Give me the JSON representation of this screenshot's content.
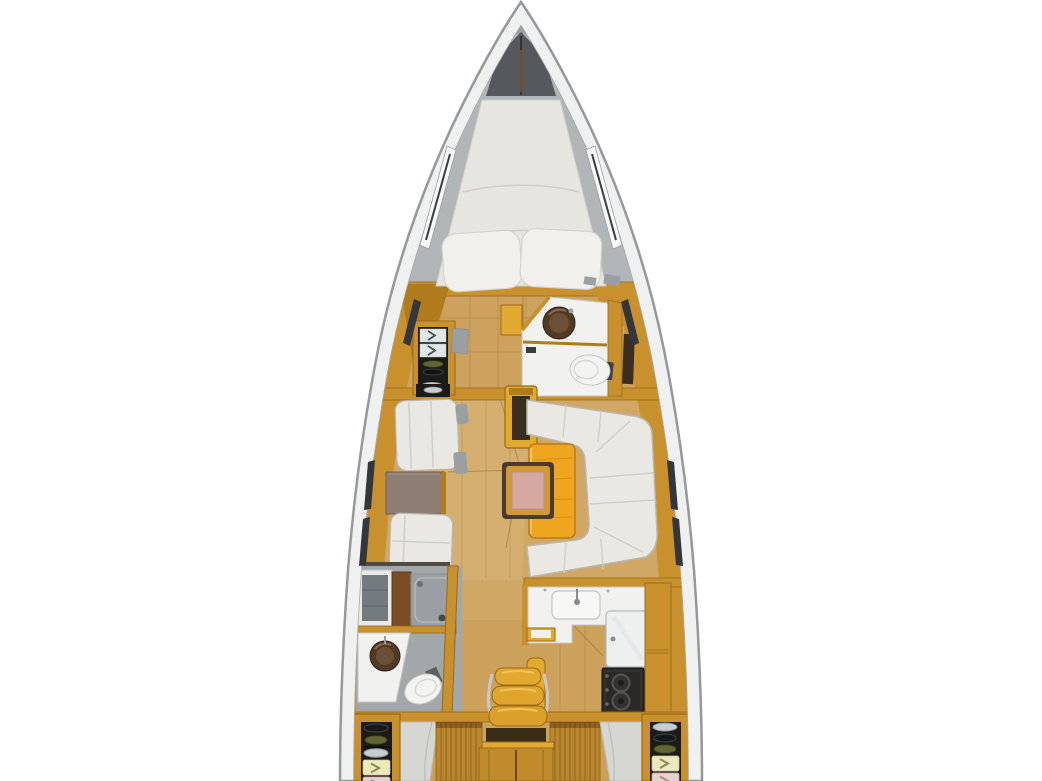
{
  "meta": {
    "description": "Top-down interior floor plan rendering of a sailing yacht hull",
    "canvas": {
      "width_px": 1042,
      "height_px": 781
    },
    "text_content": "none (image contains no rendered text)"
  },
  "areas": [
    "bow-anchor-locker",
    "forward-cabin-v-berth",
    "forward-wardrobe",
    "forward-head-toilet",
    "salon-port-settees",
    "salon-port-table",
    "mast-post",
    "salon-u-settee",
    "salon-table",
    "folding-table-leaf",
    "aft-head-shower",
    "galley",
    "nav-seat",
    "companionway-steps",
    "aft-cabin-port",
    "aft-cabin-starboard",
    "storage-locker-port",
    "storage-locker-starboard"
  ],
  "palette": {
    "pageBg": "#ffffff",
    "hullStroke": "#96989b",
    "hullFill": "#eff0f0",
    "hullLip": "#a6a9ab",
    "deck": "#b2b5b7",
    "bowTip": "#9b9ea1",
    "anchorLocker": "#55585c",
    "chainBrown": "#8a5a20",
    "floorWood": "#d0a765",
    "floorWoodAft": "#c59b53",
    "floorWoodLight": "#dcbc82",
    "plankLine": "#7a4a14",
    "woodTrim": "#c8912e",
    "woodTrimDark": "#9a6a14",
    "woodTrimDeep": "#b07b1d",
    "woodTrimLight": "#e2a930",
    "tableYellow": "#efa51f",
    "tableYellowEdge": "#b97d12",
    "slatWood": "#b8862f",
    "leafPink": "#d5a9a2",
    "leafFrame": "#4a3a30",
    "cushionWhite": "#e9e8e3",
    "cushionEdge": "#b9b8b2",
    "pillowWhite": "#f1f0ec",
    "mattressWhite": "#e6e5e0",
    "seamGray": "#cfcec8",
    "portTableBrown": "#8d7d73",
    "counterWhite": "#f1f1ef",
    "counterEdge": "#c6c7c3",
    "bathFloorGray": "#a2a7aa",
    "bathWallGray": "#747b7f",
    "showerTray": "#999fa2",
    "cabinetBrown": "#7a4e22",
    "sinkBowlDark": "#523a27",
    "sinkBowlMid": "#6b4f36",
    "stoveBlack": "#2b2927",
    "stoveRing": "#575350",
    "fridgeWhite": "#eef0f0",
    "shelfBlack": "#1d1b19",
    "dishOlive": "#5f6632",
    "dishSilver": "#c9cdd0",
    "panelCream": "#eceabc",
    "panelPink": "#e6d2ce",
    "chevCream": "#8c8a56",
    "chevPink": "#b08a84",
    "mirrorPanel": "#dfe8e6",
    "chevMirror": "#44534f",
    "hullSlot": "#33363a",
    "chromeWhite": "#f7f8f8",
    "metalGray": "#9aa0a2",
    "darkStrip": "#4e4a45",
    "stepShadow": "#3a2c16",
    "stepWood": "#c08a2d",
    "cabinMattress": "#d6d6d2",
    "toiletWhite": "#f3f3f1",
    "toiletEdge": "#c7c7c4"
  }
}
